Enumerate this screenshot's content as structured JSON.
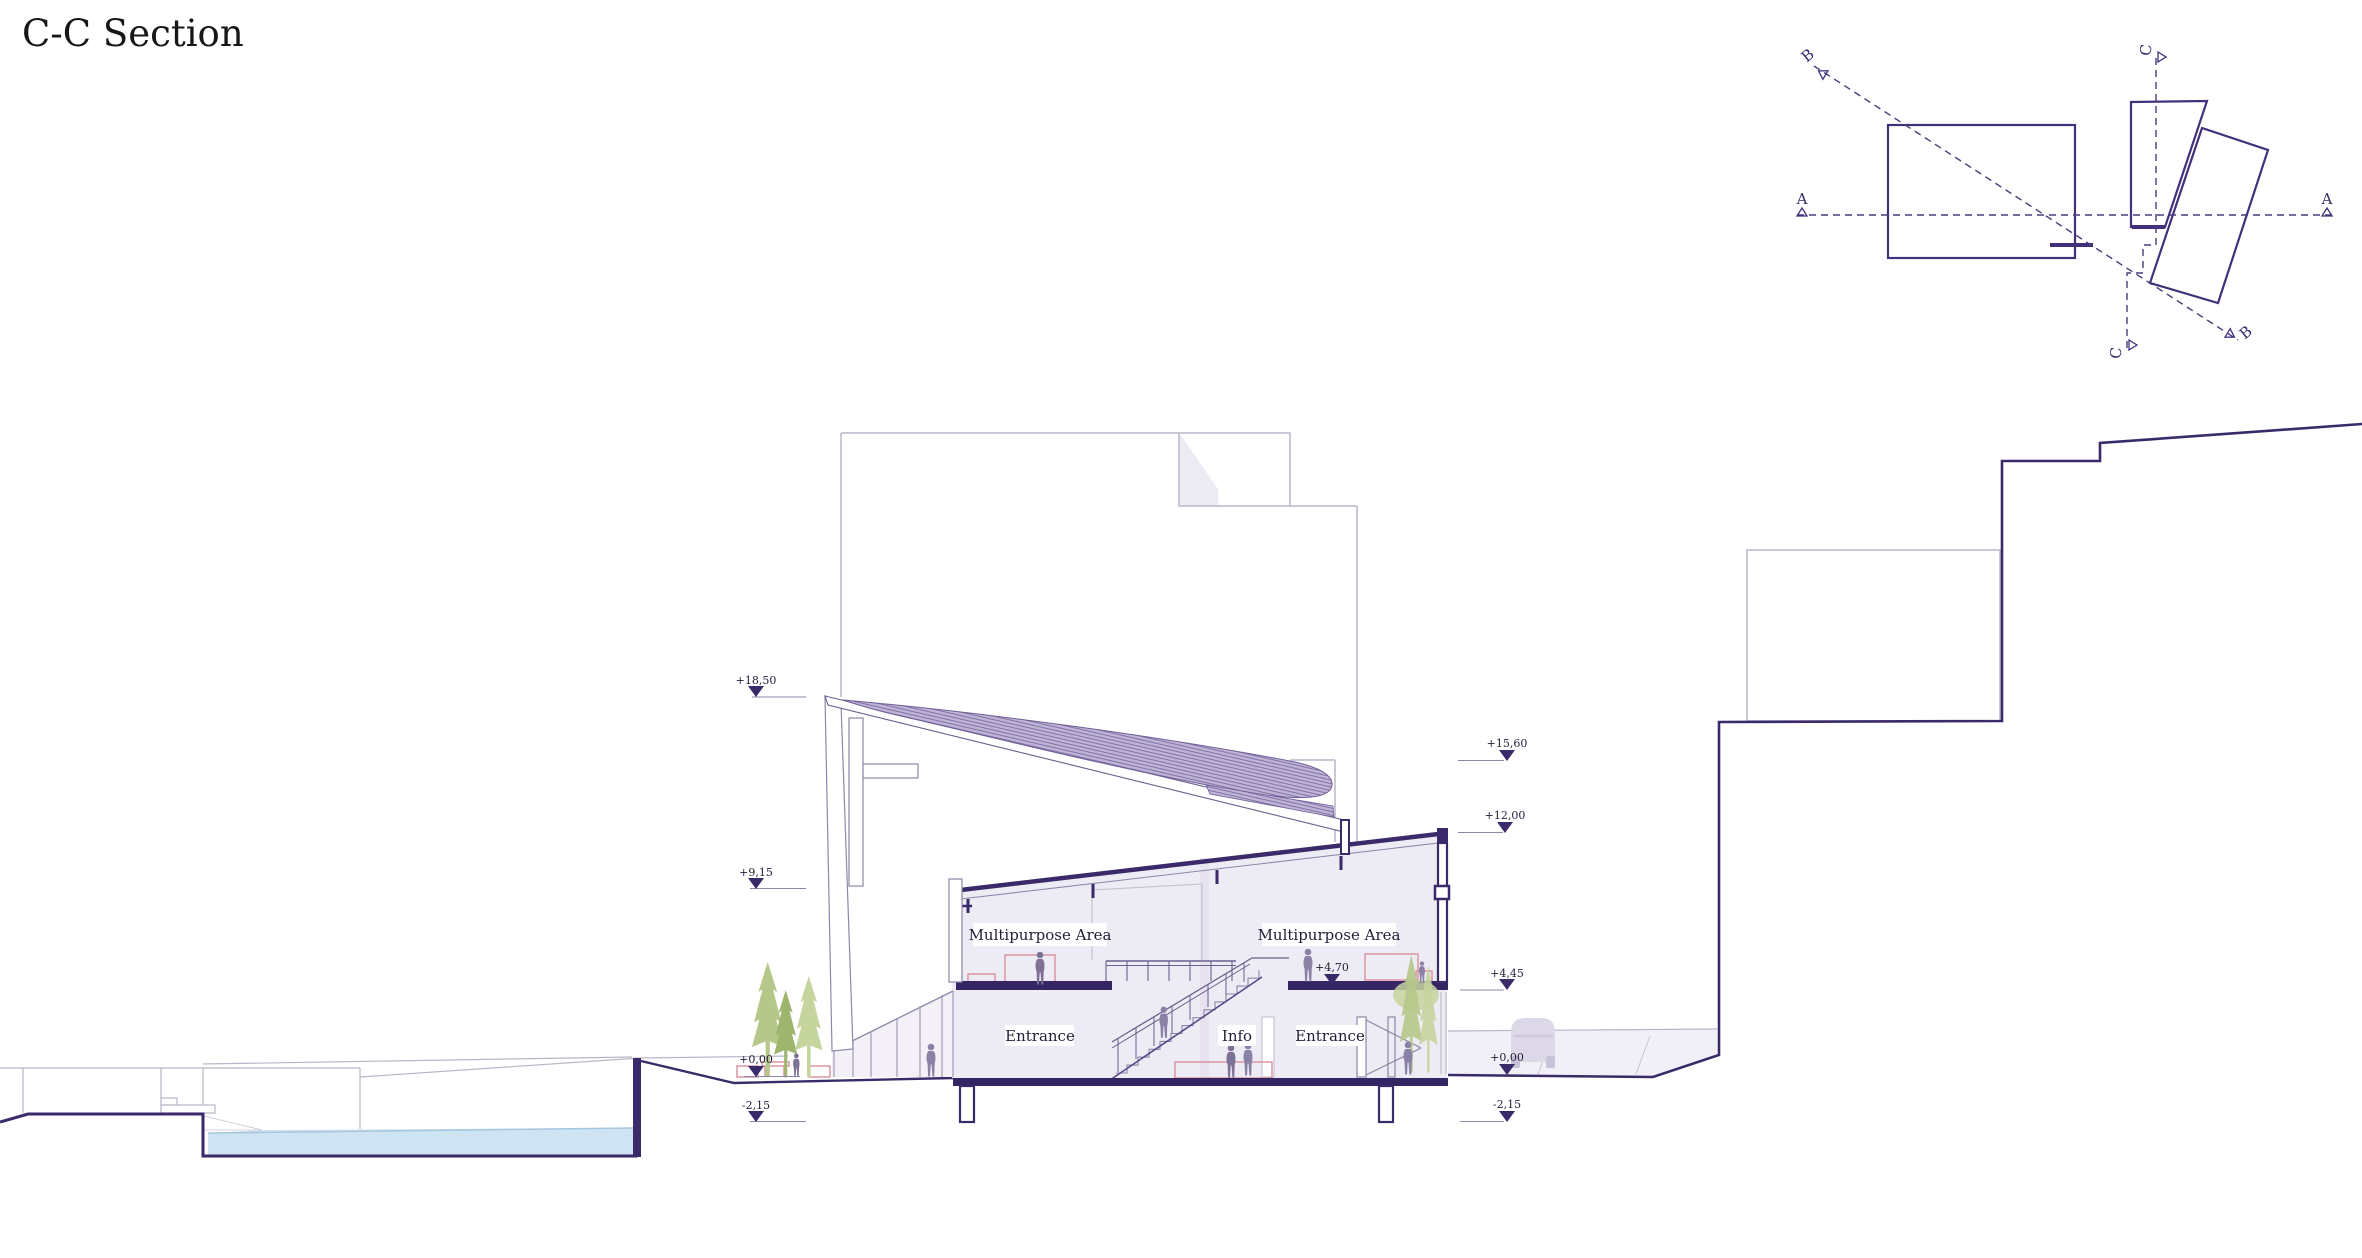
{
  "title": "C-C Section",
  "key_plan": {
    "a": "A",
    "b": "B",
    "c": "C"
  },
  "rooms": {
    "multipurpose": "Multipurpose Area",
    "entrance": "Entrance",
    "info": "Info"
  },
  "elevations": {
    "p1850": "+18,50",
    "p915": "+9,15",
    "p1560": "+15,60",
    "p1200": "+12,00",
    "p470": "+4,70",
    "p445": "+4,45",
    "zero": "+0,00",
    "m215": "-2,15"
  },
  "colors": {
    "ink": "#241c38",
    "section_dark": "#3a2a6a",
    "key_line": "#43307c",
    "light_line": "#b9b5c8",
    "mid_line": "#8d87a8",
    "interior_fill": "#edebf3",
    "leaf_fill": "#c0b4d6",
    "hatch_line": "#6f5f99",
    "water": "#cfe4f2",
    "tree_light": "#c6d49e",
    "tree_mid": "#b5c889",
    "tree_dark": "#9eb56e",
    "furniture_red": "#d9909a",
    "people": "#8b80a6",
    "car": "#dcd8e8"
  }
}
